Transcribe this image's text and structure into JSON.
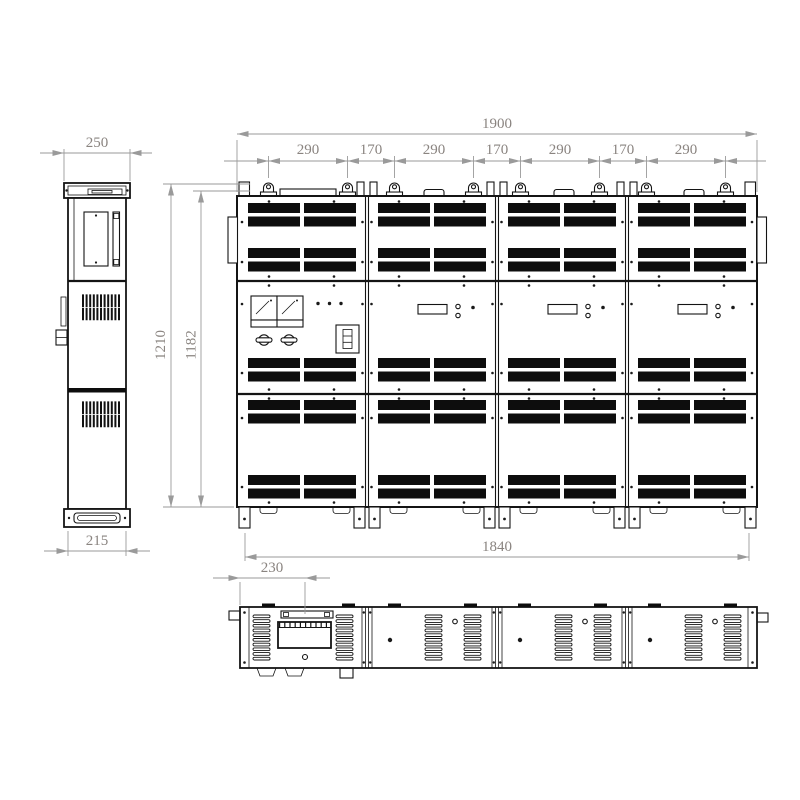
{
  "drawing": {
    "kind": "three-view cabinet technical drawing",
    "views": [
      "side-view",
      "front-view",
      "bottom-view"
    ]
  },
  "dims": {
    "side_top_width": "250",
    "side_bottom_width": "215",
    "front_total_width": "1900",
    "front_segments": [
      "290",
      "170",
      "290",
      "170",
      "290",
      "170",
      "290"
    ],
    "front_height_outer": "1210",
    "front_height_inner": "1182",
    "front_bottom_width": "1840",
    "bottom_view_offset": "230"
  },
  "colors": {
    "background": "#ffffff",
    "line": "#141414",
    "vent_fill": "#0d0d0d",
    "dimension_line": "#9a9a9a",
    "dimension_text": "#8a8480"
  }
}
